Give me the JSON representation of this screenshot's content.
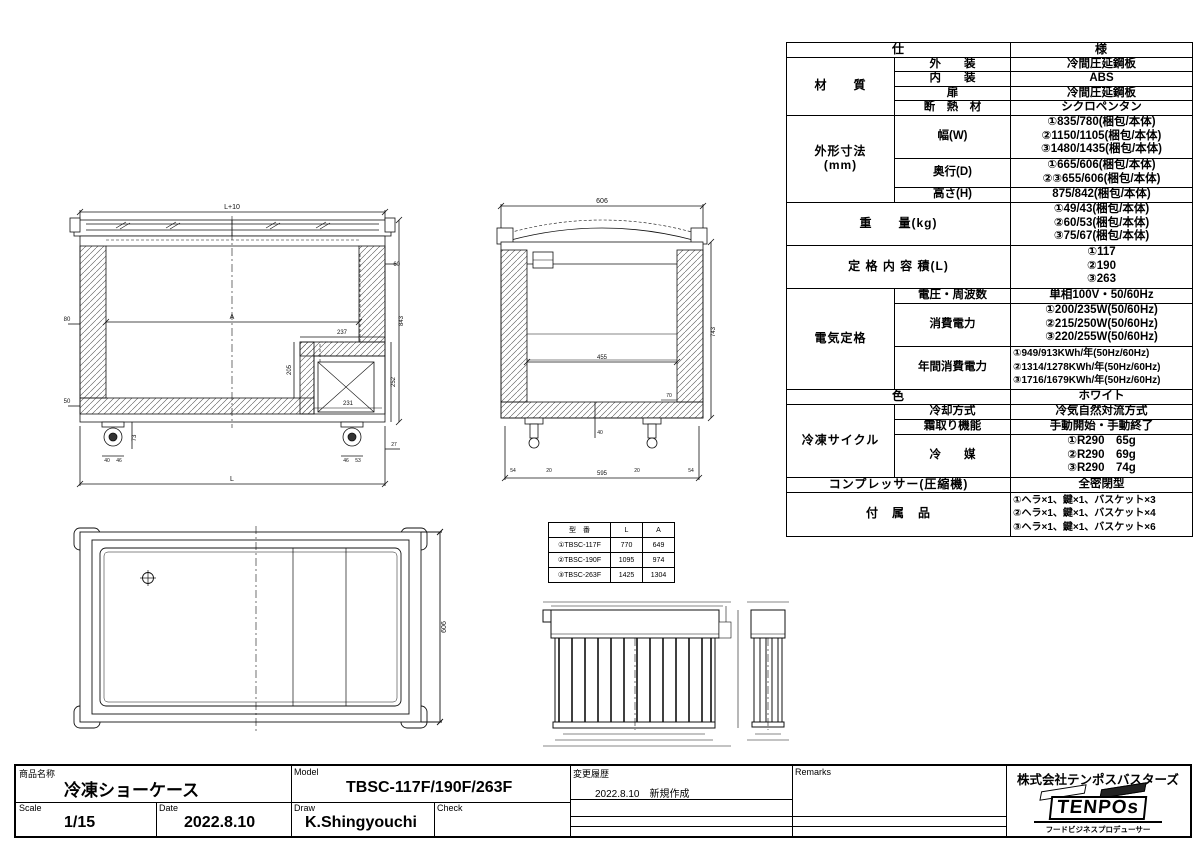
{
  "spec": {
    "header_left": "仕",
    "header_right": "様",
    "material_label": "材　　質",
    "material_rows": [
      {
        "name": "外　　装",
        "value": "冷間圧延鋼板"
      },
      {
        "name": "内　　装",
        "value": "ABS"
      },
      {
        "name": "扉",
        "value": "冷間圧延鋼板"
      },
      {
        "name": "断　熱　材",
        "value": "シクロペンタン"
      }
    ],
    "dim_label_1": "外形寸法",
    "dim_label_2": "(mm)",
    "dim_rows": [
      {
        "name": "幅(W)",
        "lines": [
          "①835/780(梱包/本体)",
          "②1150/1105(梱包/本体)",
          "③1480/1435(梱包/本体)"
        ]
      },
      {
        "name": "奥行(D)",
        "lines": [
          "①665/606(梱包/本体)",
          "②③655/606(梱包/本体)"
        ]
      },
      {
        "name": "高さ(H)",
        "lines": [
          "875/842(梱包/本体)"
        ]
      }
    ],
    "weight_label": "重　　量(kg)",
    "weight_lines": [
      "①49/43(梱包/本体)",
      "②60/53(梱包/本体)",
      "③75/67(梱包/本体)"
    ],
    "capacity_label": "定 格 内 容 積(L)",
    "capacity_lines": [
      "①117",
      "②190",
      "③263"
    ],
    "electric_label": "電気定格",
    "electric_rows": [
      {
        "name": "電圧・周波数",
        "lines": [
          "単相100V・50/60Hz"
        ]
      },
      {
        "name": "消費電力",
        "lines": [
          "①200/235W(50/60Hz)",
          "②215/250W(50/60Hz)",
          "③220/255W(50/60Hz)"
        ]
      },
      {
        "name": "年間消費電力",
        "lines": [
          "①949/913KWh/年(50Hz/60Hz)",
          "②1314/1278KWh/年(50Hz/60Hz)",
          "③1716/1679KWh/年(50Hz/60Hz)"
        ]
      }
    ],
    "color_label": "色",
    "color_value": "ホワイト",
    "cycle_label": "冷凍サイクル",
    "cycle_rows": [
      {
        "name": "冷却方式",
        "lines": [
          "冷気自然対流方式"
        ]
      },
      {
        "name": "霜取り機能",
        "lines": [
          "手動開始・手動終了"
        ]
      },
      {
        "name": "冷　　媒",
        "lines": [
          "①R290　65g",
          "②R290　69g",
          "③R290　74g"
        ]
      }
    ],
    "compressor_label": "コンプレッサー(圧縮機)",
    "compressor_value": "全密閉型",
    "accessory_label": "付　属　品",
    "accessory_lines": [
      "①ヘラ×1、鍵×1、バスケット×3",
      "②ヘラ×1、鍵×1、バスケット×4",
      "③ヘラ×1、鍵×1、バスケット×6"
    ]
  },
  "model_table": {
    "headers": [
      "型　番",
      "L",
      "A"
    ],
    "rows": [
      {
        "model": "①TBSC-117F",
        "l": "770",
        "a": "649"
      },
      {
        "model": "②TBSC-190F",
        "l": "1095",
        "a": "974"
      },
      {
        "model": "③TBSC-263F",
        "l": "1425",
        "a": "1304"
      }
    ]
  },
  "title_block": {
    "product_label": "商品名称",
    "product_name": "冷凍ショーケース",
    "model_label": "Model",
    "model_value": "TBSC-117F/190F/263F",
    "history_label": "変更履歴",
    "history_entry": "2022.8.10　新規作成",
    "remarks_label": "Remarks",
    "scale_label": "Scale",
    "scale_value": "1/15",
    "date_label": "Date",
    "date_value": "2022.8.10",
    "draw_label": "Draw",
    "draw_value": "K.Shingyouchi",
    "check_label": "Check",
    "company_name": "株式会社テンポスバスターズ",
    "logo_text": "TENPOs",
    "tagline": "フードビジネスプロデューサー"
  },
  "drawings": {
    "front": {
      "top": "L+10",
      "inner_w": "A",
      "step": "237",
      "comp_w": "231",
      "inner_h": "205",
      "comp_h": "252",
      "height": "843",
      "wall_r": "60",
      "wall_l": "80",
      "base_l": "50",
      "caster_h": "73",
      "c_l1": "40",
      "c_l2": "46",
      "c_r1": "46",
      "c_r2": "53",
      "foot": "27",
      "total": "L"
    },
    "side": {
      "top": "606",
      "inner_w": "455",
      "height": "743",
      "bottom": "595",
      "e1": "54",
      "e2": "20",
      "e3": "20",
      "e4": "54",
      "d70": "70",
      "d40": "40"
    },
    "plan": {
      "depth": "606"
    }
  }
}
